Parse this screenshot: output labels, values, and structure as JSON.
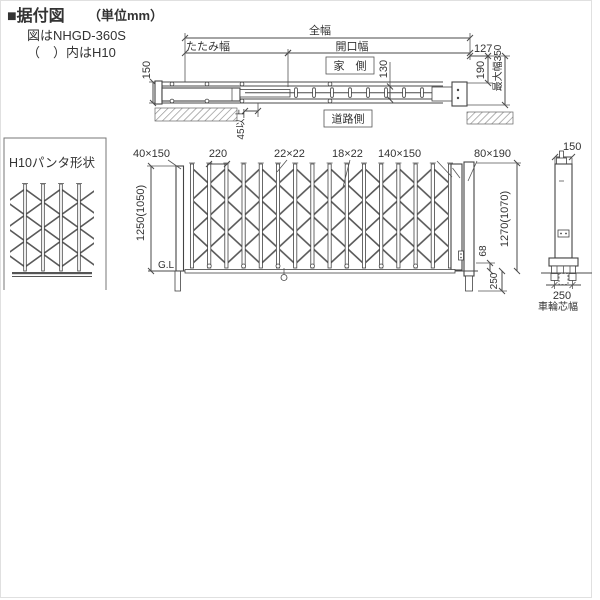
{
  "page": {
    "background": "#ffffff",
    "frame_color": "#e0e0e0"
  },
  "colors": {
    "line": "#4a4a4a",
    "text": "#333333",
    "hatch": "#8a8a8a",
    "lattice": "#5a5a5a"
  },
  "header": {
    "title": "■据付図",
    "title_unit": "（単位mm）",
    "subtitle1": "図はNHGD-360S",
    "subtitle2": "（　）内はH10"
  },
  "plan": {
    "dim_total_width": "全幅",
    "dim_fold_width": "たたみ幅",
    "dim_opening_width": "開口幅",
    "label_house_side": "家　側",
    "label_road_side": "道路側",
    "dim_rail_150": "150",
    "dim_rail_130": "130",
    "dim_offset_127": "127",
    "dim_post_190": "190",
    "dim_max_350": "最大幅350",
    "dim_clearance_45": "45以上"
  },
  "pantograph": {
    "title": "H10パンタ形状"
  },
  "elevation": {
    "dim_left_post": "40×150",
    "dim_pitch": "220",
    "dim_bar_large": "22×22",
    "dim_bar_small": "18×22",
    "dim_right_post": "140×150",
    "dim_support_post": "80×190",
    "dim_caster_post_150": "150",
    "dim_height_left": "1250(1050)",
    "dim_height_right": "1270(1070)",
    "dim_gap_68": "68",
    "dim_embed_250": "250",
    "label_ground": "G.L",
    "dim_wheel_250": "250",
    "label_wheel_width": "車輪芯幅"
  }
}
